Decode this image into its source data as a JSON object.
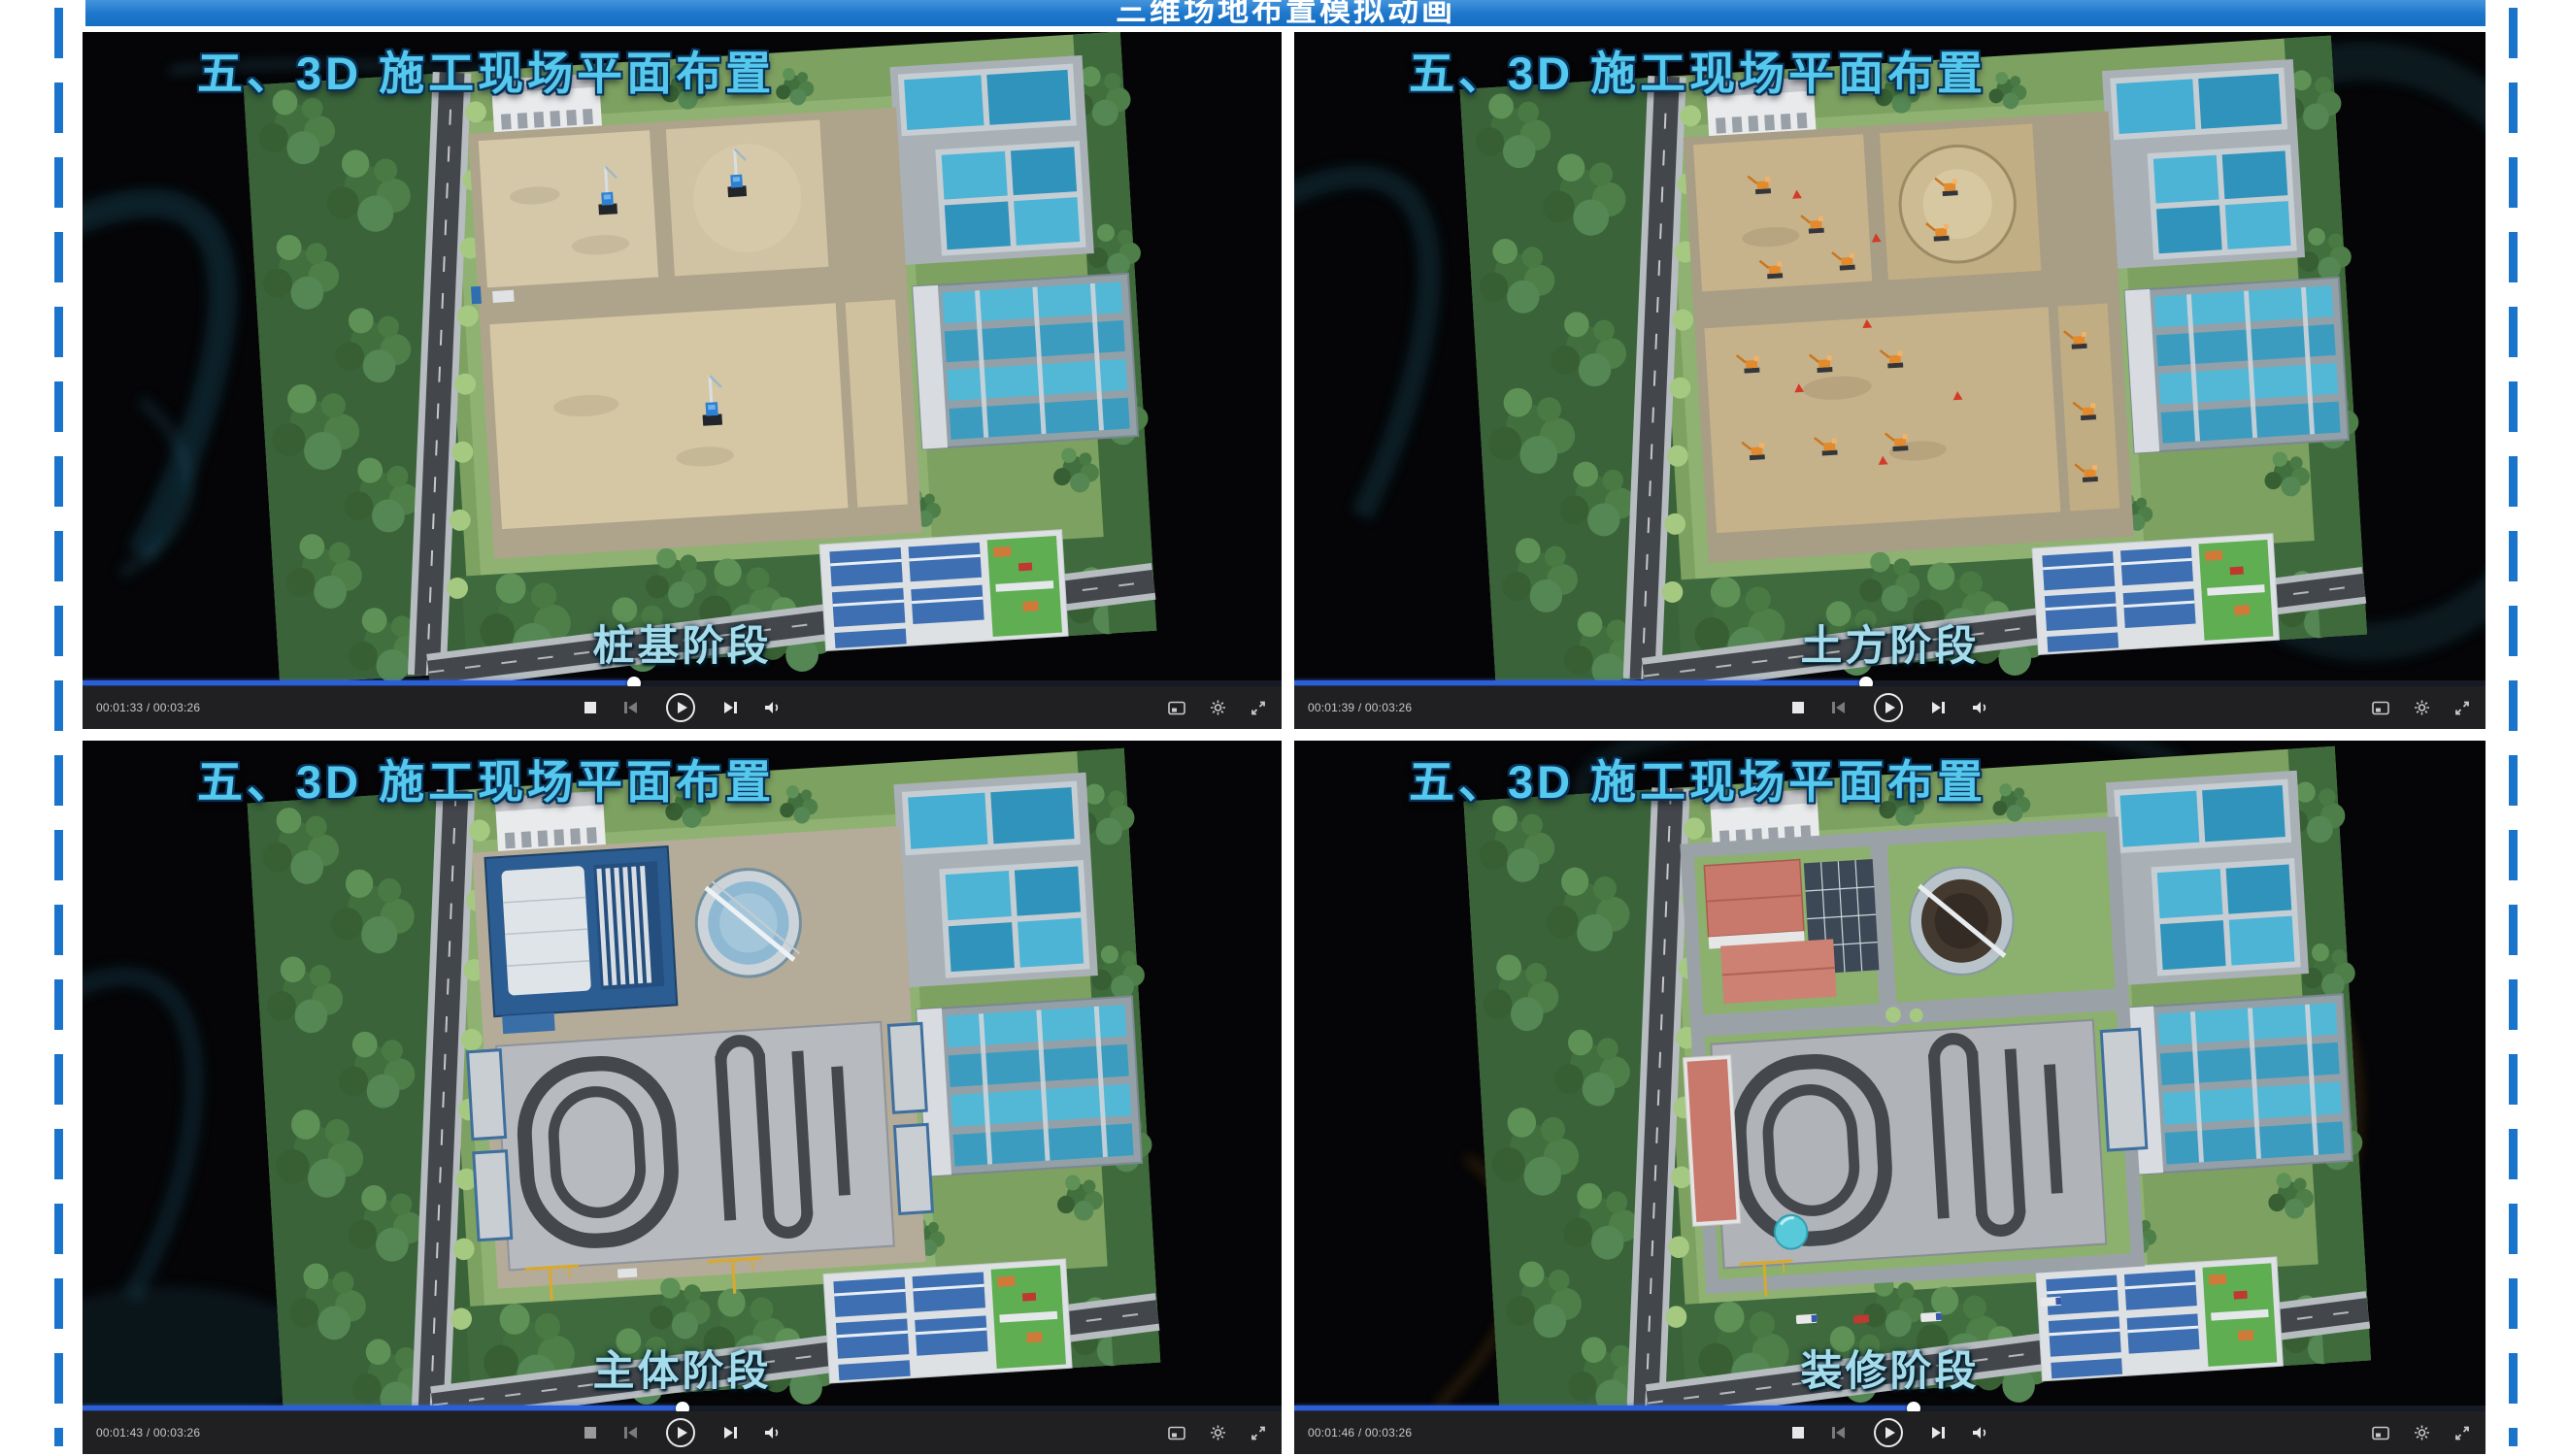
{
  "page": {
    "window_title": "三维场地布置模拟动画",
    "colors": {
      "accent_blue": "#1b74cc",
      "title_bar_bg": "#1d76cb",
      "progress_blue": "#2a5fd7",
      "overlay_title_cyan": "#55c8ee",
      "caption_cyan": "#a5dcec",
      "control_bar_bg": "#202023"
    }
  },
  "chrome": {
    "icons": [
      "stop-icon",
      "previous-frame-icon",
      "play-icon",
      "next-frame-icon",
      "volume-icon",
      "snapshot-icon",
      "settings-gear-icon",
      "fullscreen-icon"
    ]
  },
  "players": [
    {
      "stage": "pile-foundation",
      "overlay_title": "五、3D 施工现场平面布置",
      "caption": "桩基阶段",
      "time_display": "00:01:33 / 00:03:26",
      "progress_pct": "46%"
    },
    {
      "stage": "earthwork",
      "overlay_title": "五、3D 施工现场平面布置",
      "caption": "土方阶段",
      "time_display": "00:01:39 / 00:03:26",
      "progress_pct": "48%"
    },
    {
      "stage": "main-structure",
      "overlay_title": "五、3D 施工现场平面布置",
      "caption": "主体阶段",
      "time_display": "00:01:43 / 00:03:26",
      "progress_pct": "50%"
    },
    {
      "stage": "decoration",
      "overlay_title": "五、3D 施工现场平面布置",
      "caption": "装修阶段",
      "time_display": "00:01:46 / 00:03:26",
      "progress_pct": "52%"
    }
  ]
}
